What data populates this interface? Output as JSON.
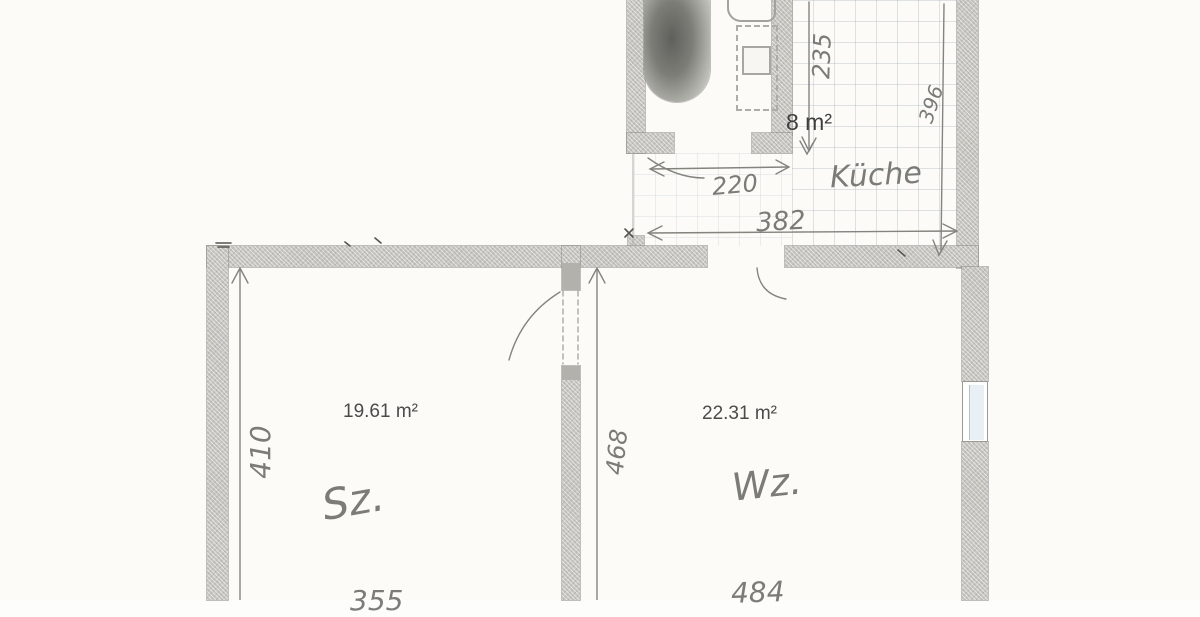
{
  "floorplan": {
    "bathroom": {
      "area": "8 m²",
      "width_cm": "220",
      "depth_cm": "235"
    },
    "kitchen": {
      "name": "Küche",
      "width_cm": "382",
      "depth_cm": "396"
    },
    "bedroom": {
      "name": "Sz.",
      "area": "19.61 m²",
      "depth_cm": "410",
      "width_cm": "355"
    },
    "livingroom": {
      "name": "Wz.",
      "area": "22.31 m²",
      "depth_cm": "468",
      "width_cm": "484"
    },
    "colors": {
      "paper": "#fcfbf8",
      "wall": "#c6c5c0",
      "pencil": "#6f6f6a",
      "print": "#3e3e3c",
      "line": "#8a8a84"
    }
  }
}
